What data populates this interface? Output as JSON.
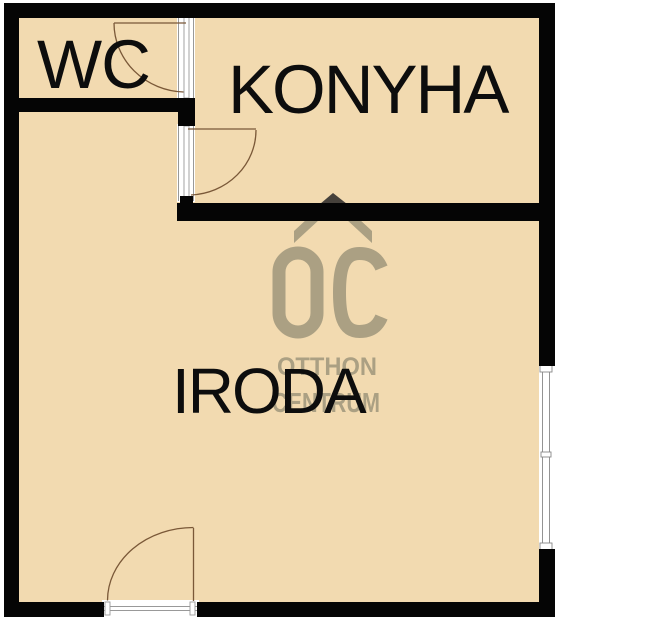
{
  "floorplan": {
    "rooms": [
      {
        "name": "wc",
        "label": "WC"
      },
      {
        "name": "konyha",
        "label": "KONYHA"
      },
      {
        "name": "iroda",
        "label": "IRODA"
      }
    ],
    "watermark": {
      "monogram": "OC",
      "word1": "OTTHON",
      "word2": "CENTRUM"
    },
    "colors": {
      "background": "#ffffff",
      "floor": "#f2dab0",
      "wall": "#050505",
      "watermark": "#aba083",
      "watermark_roof_tip": "#46413b",
      "door_line": "#7a5838",
      "frame_line": "#999999",
      "window_line": "#888888",
      "label_text": "#0d0d0d"
    }
  }
}
